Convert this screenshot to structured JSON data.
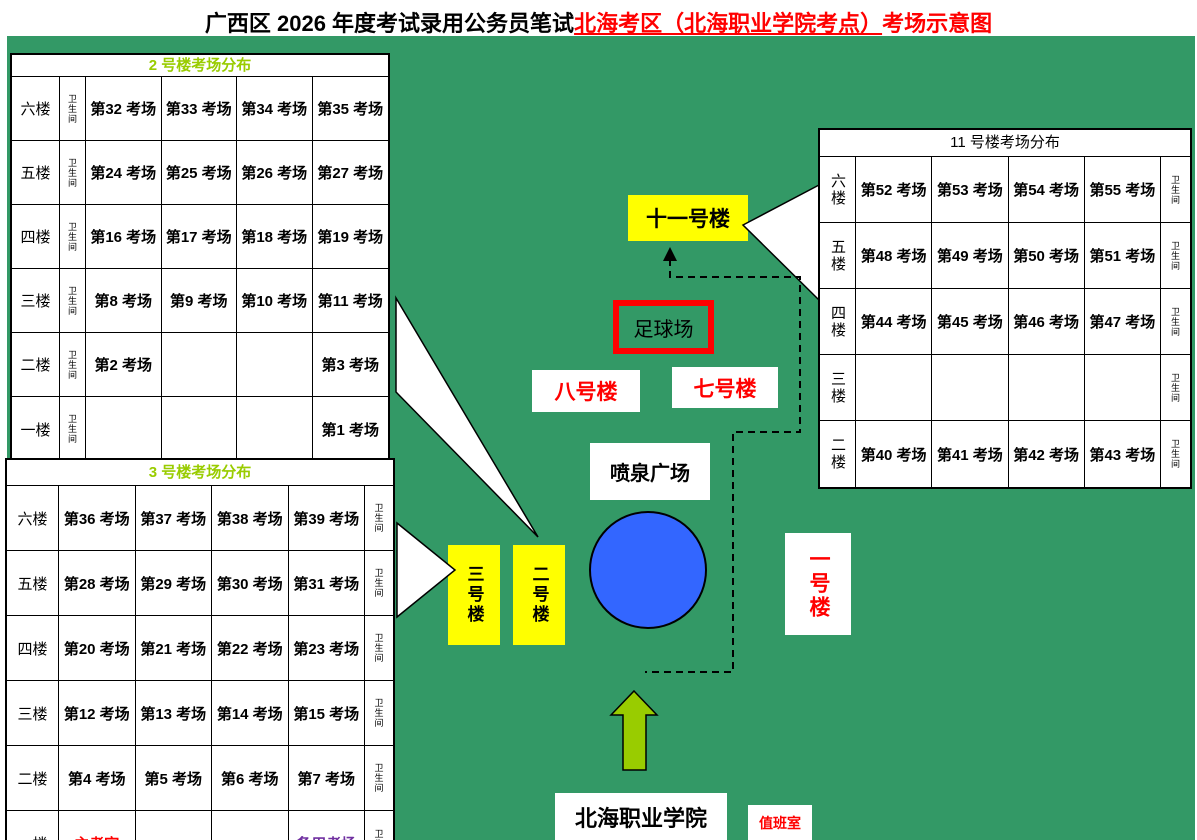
{
  "title": {
    "part1_black": "广西区 2026 年度考试录用公务员笔试",
    "part2_red_underlined": "北海考区（北海职业学院考点）",
    "part3_red": "考场示意图"
  },
  "colors": {
    "map_bg": "#339966",
    "area_green": "#99cc00",
    "yellow": "#ffff00",
    "blue": "#3366ff",
    "red": "#ff0000",
    "purple": "#7030a0",
    "header_green": "#99cc00"
  },
  "tables": {
    "building2": {
      "title": "2 号楼考场分布",
      "wc_label": "卫生间",
      "rows": [
        {
          "floor": "六楼",
          "rooms": [
            "第32 考场",
            "第33 考场",
            "第34 考场",
            "第35 考场"
          ]
        },
        {
          "floor": "五楼",
          "rooms": [
            "第24 考场",
            "第25 考场",
            "第26 考场",
            "第27 考场"
          ]
        },
        {
          "floor": "四楼",
          "rooms": [
            "第16 考场",
            "第17 考场",
            "第18 考场",
            "第19 考场"
          ]
        },
        {
          "floor": "三楼",
          "rooms": [
            "第8 考场",
            "第9 考场",
            "第10 考场",
            "第11 考场"
          ]
        },
        {
          "floor": "二楼",
          "rooms": [
            "第2 考场",
            "",
            "",
            "第3 考场"
          ]
        },
        {
          "floor": "一楼",
          "rooms": [
            "",
            "",
            "",
            "第1 考场"
          ]
        }
      ]
    },
    "building3": {
      "title": "3 号楼考场分布",
      "wc_label": "卫生间",
      "rows": [
        {
          "floor": "六楼",
          "rooms": [
            "第36 考场",
            "第37 考场",
            "第38 考场",
            "第39 考场"
          ]
        },
        {
          "floor": "五楼",
          "rooms": [
            "第28 考场",
            "第29 考场",
            "第30 考场",
            "第31 考场"
          ]
        },
        {
          "floor": "四楼",
          "rooms": [
            "第20 考场",
            "第21 考场",
            "第22 考场",
            "第23 考场"
          ]
        },
        {
          "floor": "三楼",
          "rooms": [
            "第12 考场",
            "第13 考场",
            "第14 考场",
            "第15 考场"
          ]
        },
        {
          "floor": "二楼",
          "rooms": [
            "第4 考场",
            "第5 考场",
            "第6 考场",
            "第7 考场"
          ]
        },
        {
          "floor": "一楼",
          "rooms": [
            "主考室",
            "",
            "",
            "备用考场"
          ],
          "classes": [
            "red",
            "",
            "",
            "purple"
          ]
        }
      ]
    },
    "building11": {
      "title": "11 号楼考场分布",
      "wc_label": "卫生间",
      "rows": [
        {
          "floor": "六楼",
          "rooms": [
            "第52 考场",
            "第53 考场",
            "第54 考场",
            "第55 考场"
          ]
        },
        {
          "floor": "五楼",
          "rooms": [
            "第48 考场",
            "第49 考场",
            "第50 考场",
            "第51 考场"
          ]
        },
        {
          "floor": "四楼",
          "rooms": [
            "第44 考场",
            "第45 考场",
            "第46 考场",
            "第47 考场"
          ]
        },
        {
          "floor": "三楼",
          "rooms": [
            "",
            "",
            "",
            ""
          ]
        },
        {
          "floor": "二楼",
          "rooms": [
            "第40 考场",
            "第41 考场",
            "第42 考场",
            "第43 考场"
          ]
        }
      ]
    }
  },
  "map": {
    "building11_label": "十一号楼",
    "football_field_label": "足球场",
    "building8_label": "八号楼",
    "building7_label": "七号楼",
    "fountain_plaza_label": "喷泉广场",
    "building3_label": "三号楼",
    "building2_label": "二号楼",
    "building1_label": "一号楼",
    "school_name": "北海职业学院",
    "duty_room_label": "值班室"
  }
}
